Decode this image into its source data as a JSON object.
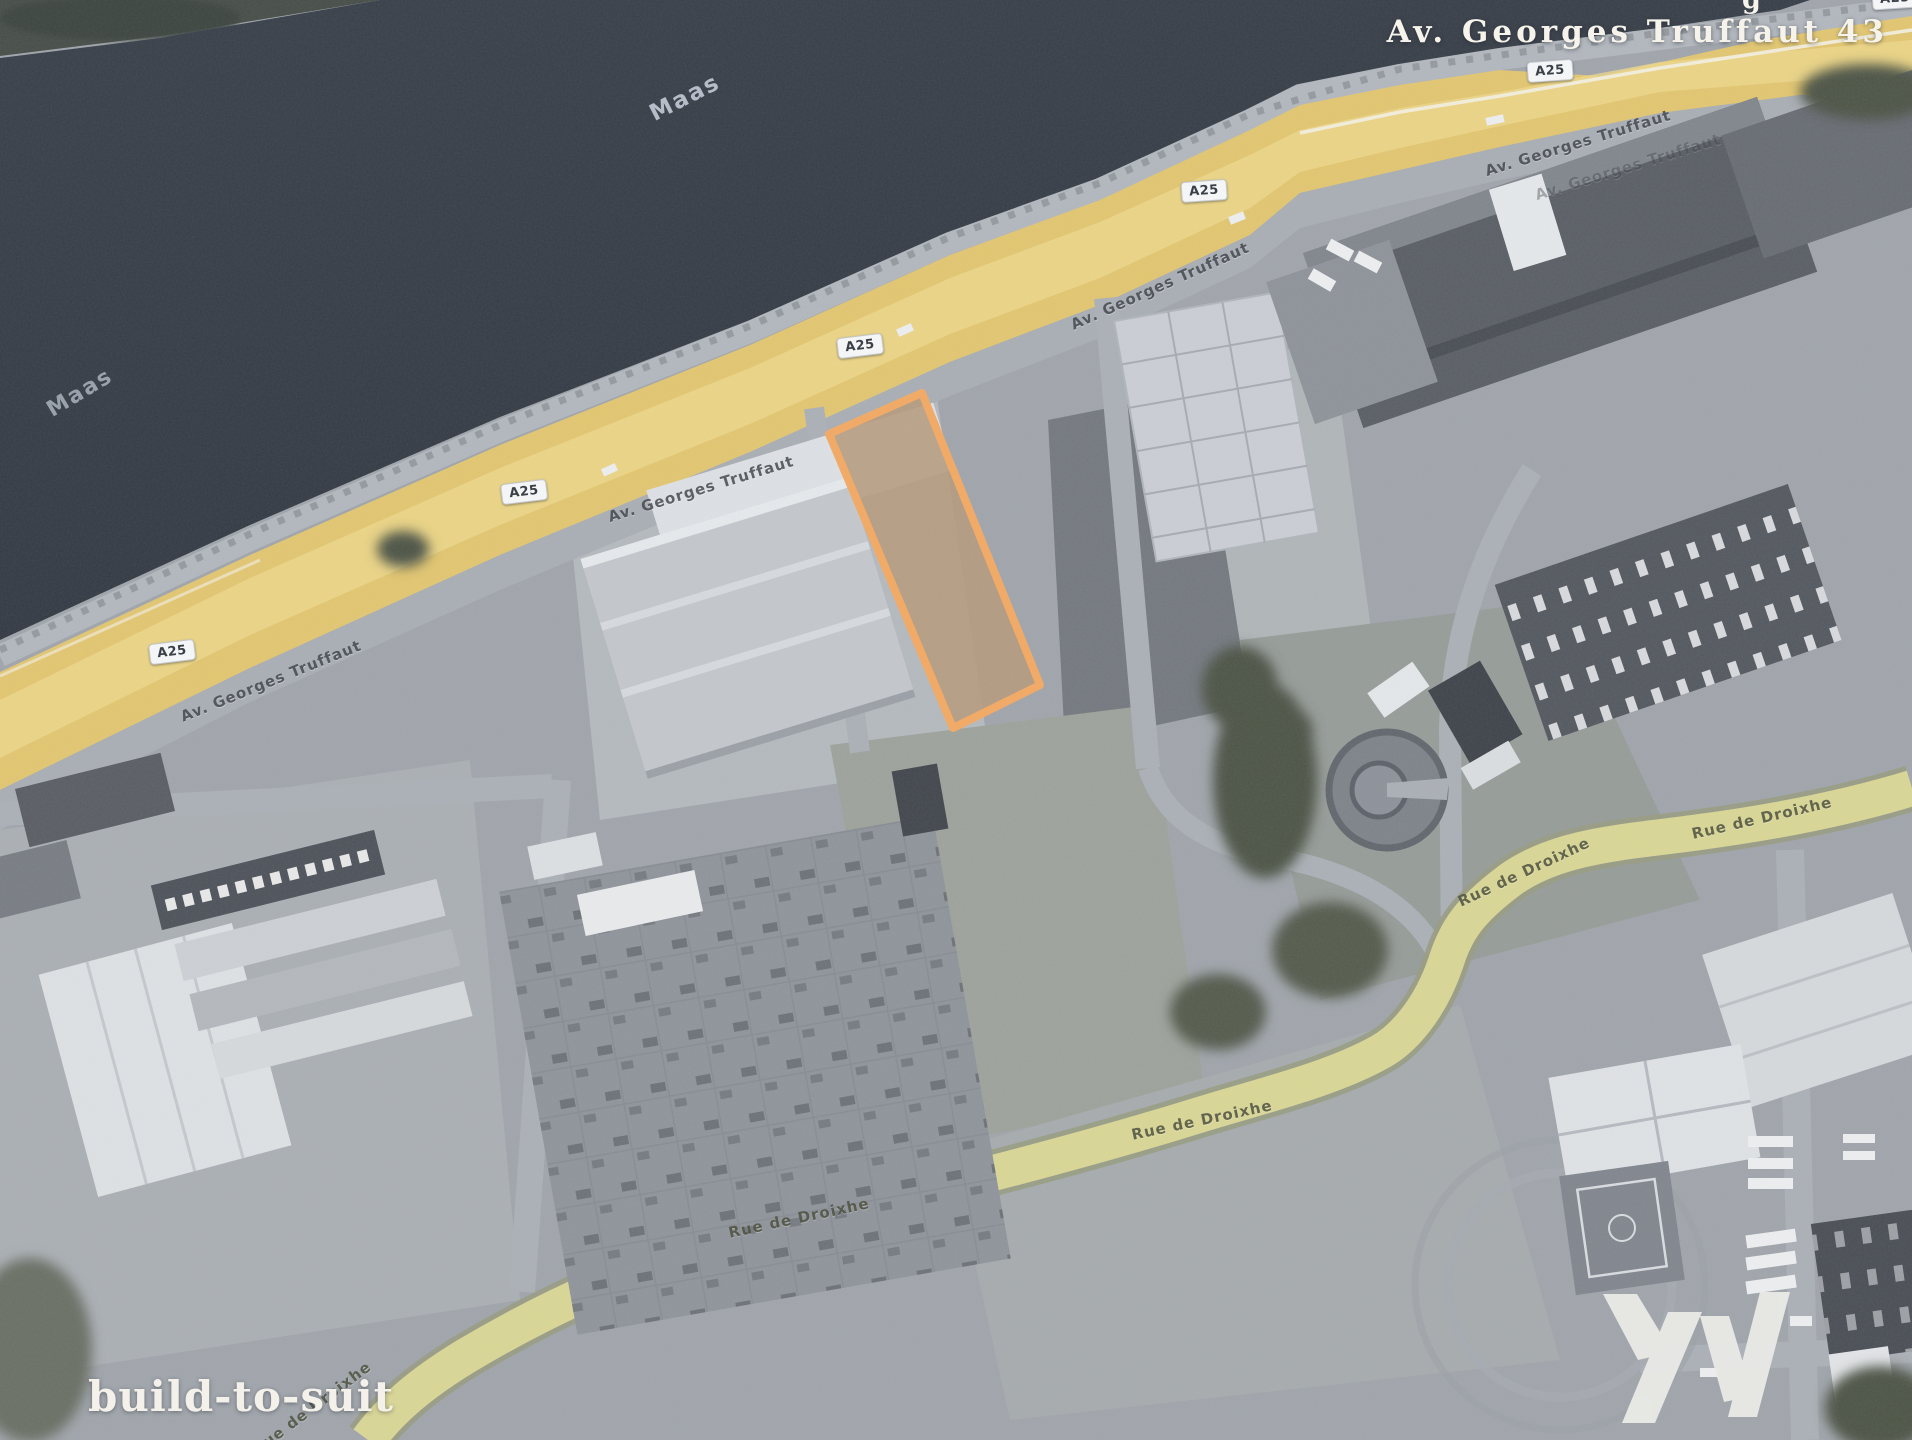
{
  "meta": {
    "type": "aerial-site-plan"
  },
  "header": {
    "address_label": "Av. Georges Truffaut 43",
    "top_edge_fragment": "g"
  },
  "watermark": {
    "label": "build-to-suit"
  },
  "river_labels": [
    "Maas",
    "Maas"
  ],
  "badges": [
    "A25",
    "A25",
    "A25",
    "A25",
    "A25",
    "A25"
  ],
  "street_labels": [
    "Av. Georges Truffaut",
    "Av. Georges Truffaut",
    "Av. Georges Truffaut",
    "Av. Georges Truffaut",
    "Av. Georges Truffaut"
  ],
  "rue_labels": [
    "Rue de Droixhe",
    "Rue de Droixhe",
    "Rue de Droixhe",
    "Rue de Droixhe",
    "Rue de Droixhe"
  ],
  "parcel": {
    "description": "highlighted available plot"
  },
  "colors": {
    "water": "#3b414b",
    "highway_yellow": "#e2c670",
    "secondary_road_yellow": "#d9d695",
    "parcel_fill": "#b59a7c",
    "parcel_outline": "#f3a963",
    "label_light": "#f6f3eb"
  }
}
